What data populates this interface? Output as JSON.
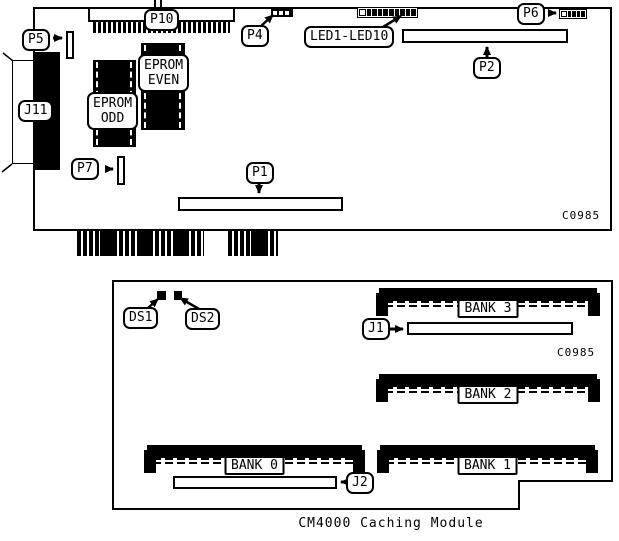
{
  "caption": "CM4000 Caching Module",
  "colors": {
    "ink": "#000000",
    "background": "#ffffff"
  },
  "top_board": {
    "part_code": "C0985",
    "labels": {
      "p5": "P5",
      "p10": "P10",
      "p4": "P4",
      "led_range": "LED1-LED10",
      "p6": "P6",
      "p2": "P2",
      "j11": "J11",
      "p7": "P7",
      "p1": "P1",
      "eprom_even_line1": "EPROM",
      "eprom_even_line2": "EVEN",
      "eprom_odd_line1": "EPROM",
      "eprom_odd_line2": "ODD"
    }
  },
  "bottom_board": {
    "part_code": "C0985",
    "labels": {
      "ds1": "DS1",
      "ds2": "DS2",
      "j1": "J1",
      "j2": "J2",
      "bank0": "BANK 0",
      "bank1": "BANK 1",
      "bank2": "BANK 2",
      "bank3": "BANK 3"
    }
  }
}
